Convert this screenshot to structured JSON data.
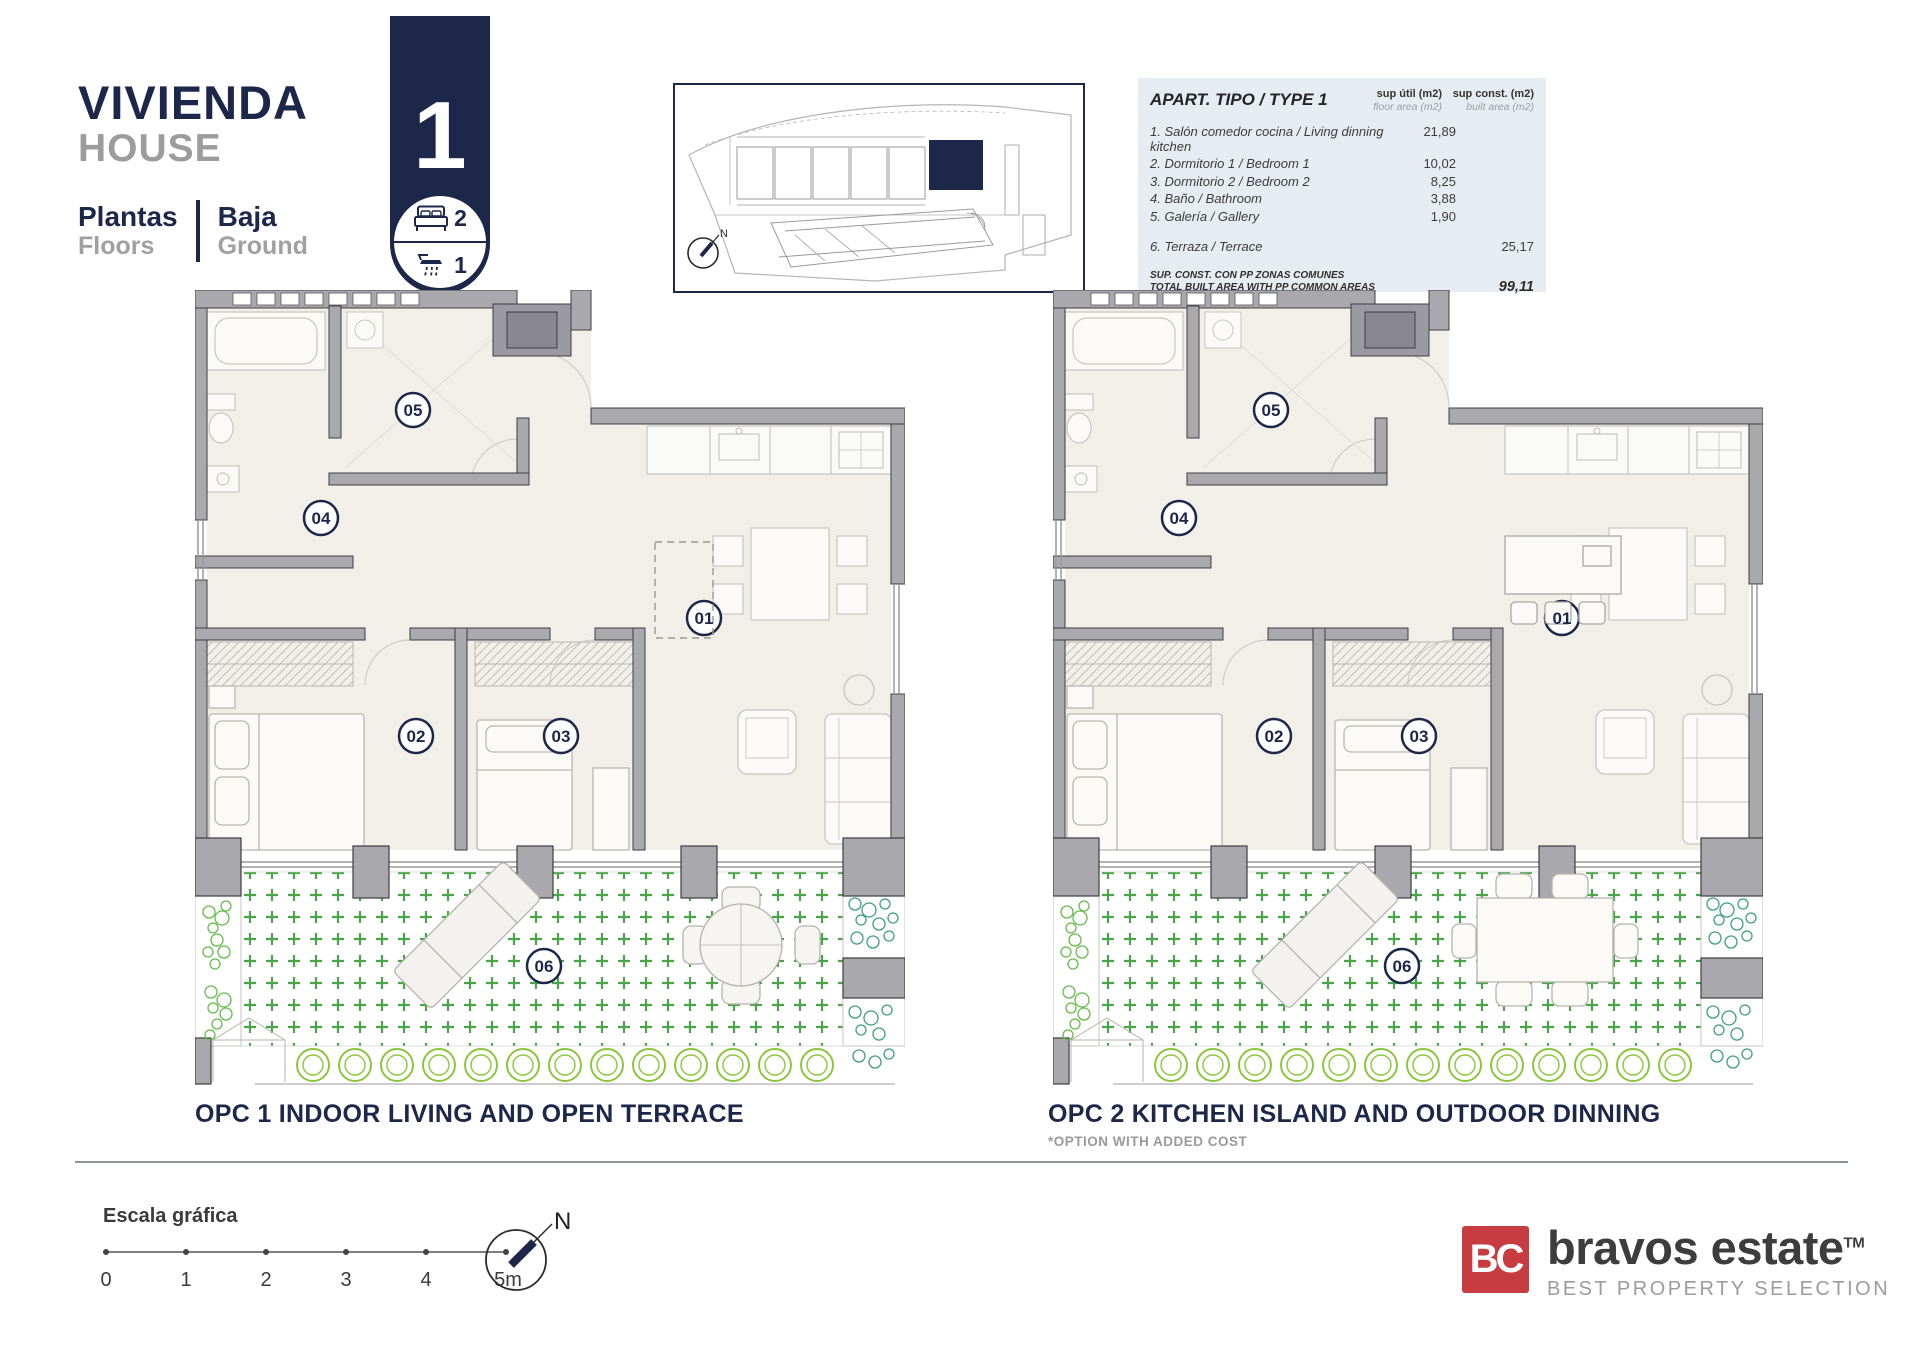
{
  "header": {
    "title": "VIVIENDA",
    "subtitle": "HOUSE",
    "floors_label_es": "Plantas",
    "floors_label_en": "Floors",
    "floor_value_es": "Baja",
    "floor_value_en": "Ground"
  },
  "badge": {
    "number": "1",
    "bedrooms": "2",
    "bathrooms": "1"
  },
  "siteplan": {
    "north_label": "N"
  },
  "area_table": {
    "title": "APART. TIPO / TYPE 1",
    "col_util_line1": "sup útil (m2)",
    "col_util_line2": "floor area (m2)",
    "col_const_line1": "sup const. (m2)",
    "col_const_line2": "built area (m2)",
    "rows": [
      {
        "label": "1. Salón comedor cocina / Living dinning kitchen",
        "util": "21,89",
        "const": ""
      },
      {
        "label": "2. Dormitorio 1 / Bedroom 1",
        "util": "10,02",
        "const": ""
      },
      {
        "label": "3. Dormitorio 2 / Bedroom 2",
        "util": "8,25",
        "const": ""
      },
      {
        "label": "4. Baño / Bathroom",
        "util": "3,88",
        "const": ""
      },
      {
        "label": "5. Galería / Gallery",
        "util": "1,90",
        "const": ""
      },
      {
        "label": "6. Terraza / Terrace",
        "util": "",
        "const": "25,17"
      }
    ],
    "total_label_es": "SUP. CONST. CON PP ZONAS COMUNES",
    "total_label_en": "TOTAL BUILT AREA WITH PP COMMON AREAS",
    "total_value": "99,11"
  },
  "rooms": [
    "01",
    "02",
    "03",
    "04",
    "05",
    "06"
  ],
  "plans": {
    "opc1": {
      "caption": "OPC 1 INDOOR LIVING AND OPEN TERRACE"
    },
    "opc2": {
      "caption": "OPC 2 KITCHEN ISLAND AND OUTDOOR DINNING",
      "note": "*OPTION WITH ADDED COST"
    }
  },
  "scalebar": {
    "label": "Escala gráfica",
    "ticks": [
      "0",
      "1",
      "2",
      "3",
      "4",
      "5m"
    ]
  },
  "compass": {
    "north_label": "N"
  },
  "logo": {
    "initials": "BC",
    "name": "bravos estate",
    "trademark": "TM",
    "tagline": "BEST PROPERTY SELECTION"
  },
  "colors": {
    "navy": "#1c2749",
    "red": "#c63c40",
    "wall_gray": "#a9a9ad",
    "terrace_green": "#4aa54a",
    "hedge_green": "#8cc63f"
  }
}
